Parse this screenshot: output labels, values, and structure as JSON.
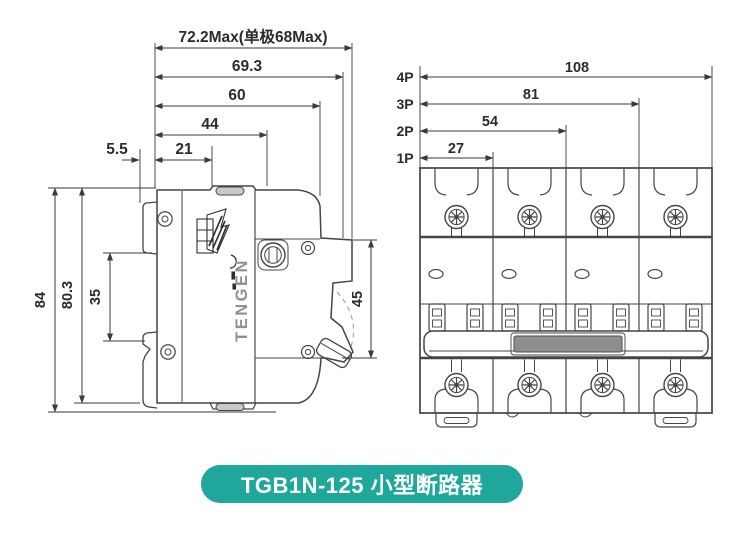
{
  "side_view": {
    "top_dims": {
      "width_max": "72.2Max(单极68Max)",
      "d693": "69.3",
      "d60": "60",
      "d44": "44",
      "d55": "5.5",
      "d21": "21"
    },
    "left_dims": {
      "d84": "84",
      "d803": "80.3",
      "d35": "35"
    },
    "right_dim": {
      "d45": "45"
    },
    "brand_text": "TENGEN"
  },
  "front_view": {
    "dims": [
      {
        "pole": "4P",
        "width": "108"
      },
      {
        "pole": "3P",
        "width": "81"
      },
      {
        "pole": "2P",
        "width": "54"
      },
      {
        "pole": "1P",
        "width": "27"
      }
    ]
  },
  "caption": {
    "label": "TGB1N-125 小型断路器"
  },
  "colors": {
    "background": "#ffffff",
    "line": "#454545",
    "dim_text": "#2b2b2b",
    "badge_bg": "#1ea79a",
    "badge_text": "#ffffff",
    "brand_gray": "#909090",
    "grip_gray": "#8e8e8e",
    "slot_gray": "#c9c9c9"
  }
}
